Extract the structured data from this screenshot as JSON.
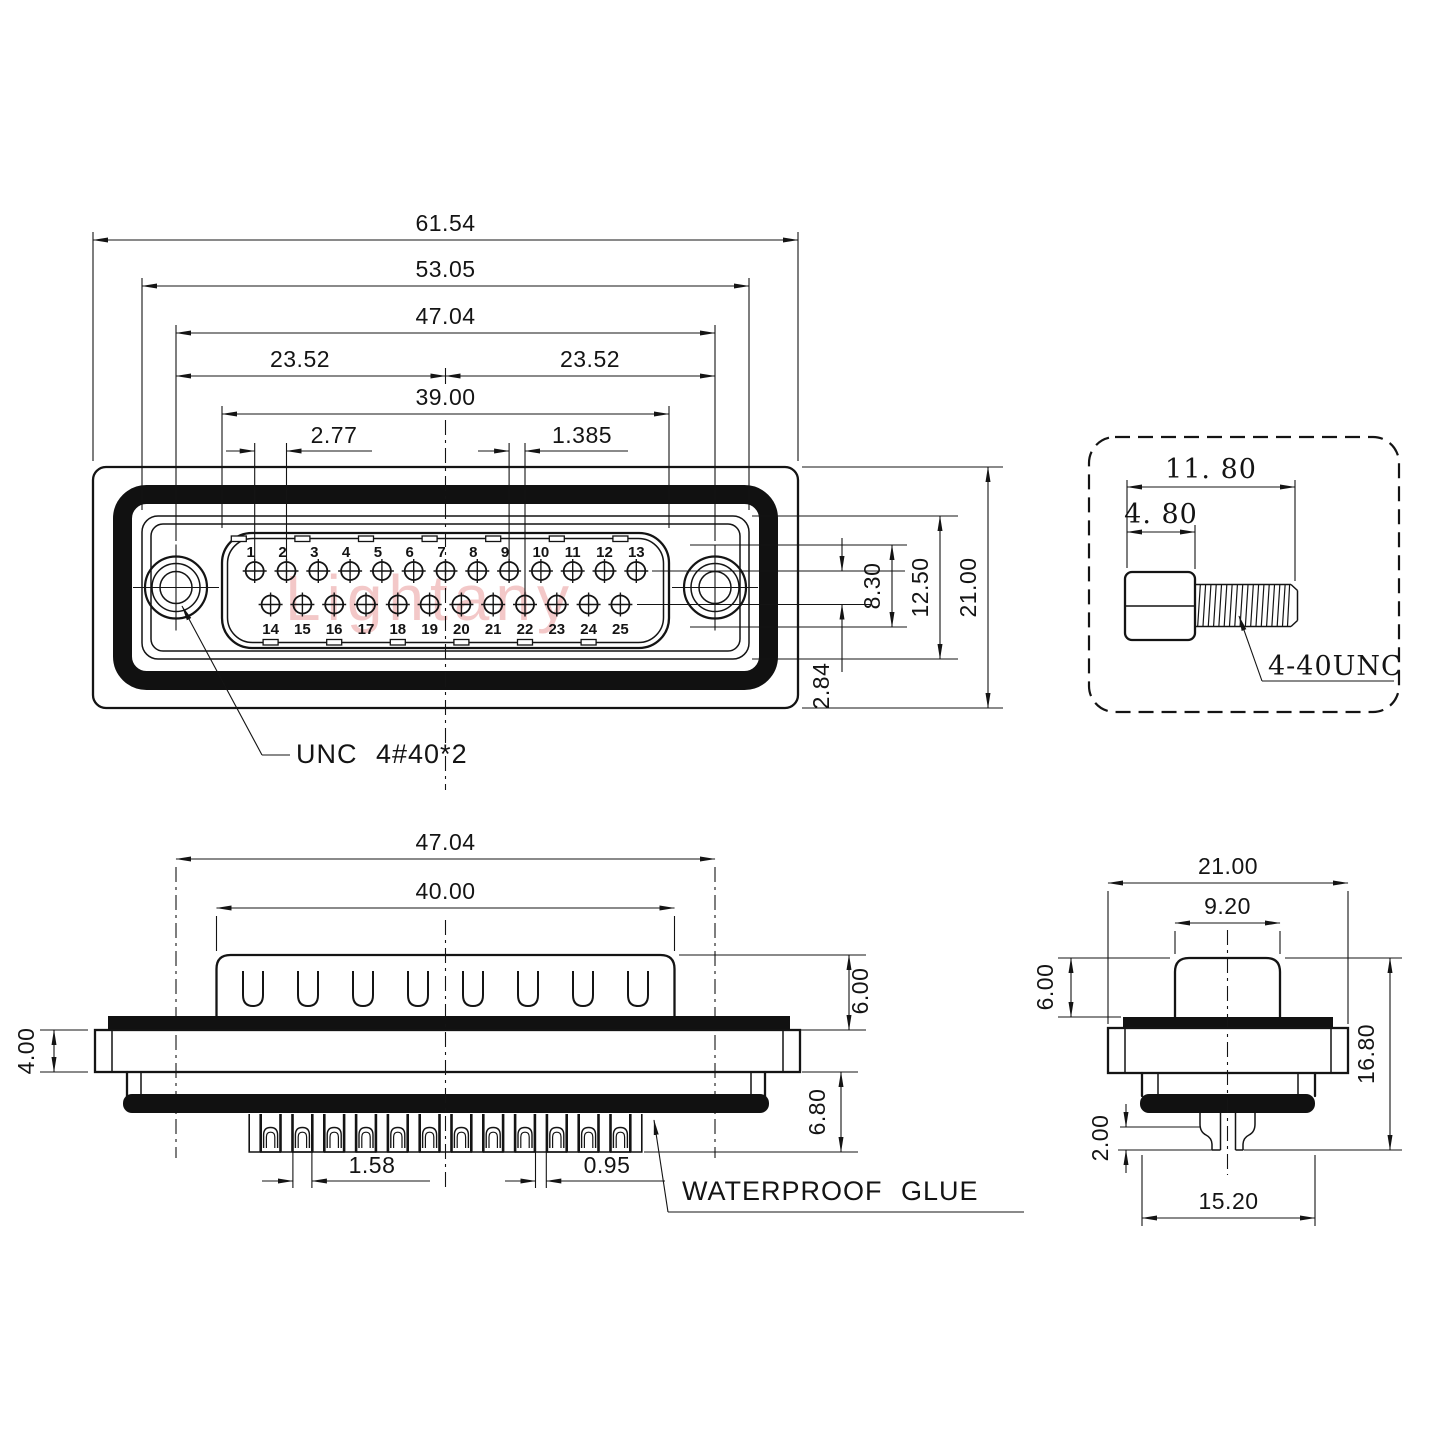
{
  "watermark": {
    "text": "Lightany"
  },
  "colors": {
    "line": "#141414",
    "watermark": "#eeb2b2"
  },
  "front": {
    "dim_overall_w": "61.54",
    "dim_gasket_w": "53.05",
    "dim_hole_span": "47.04",
    "dim_half_l": "23.52",
    "dim_half_r": "23.52",
    "dim_shell_w": "39.00",
    "dim_pitch": "2.77",
    "dim_offset": "1.385",
    "dim_pinfield_h": "8.30",
    "dim_insert_h": "12.50",
    "dim_overall_h": "21.00",
    "dim_row_gap": "2.84",
    "thread_label": "UNC 4#40*2",
    "pins_top": [
      "1",
      "2",
      "3",
      "4",
      "5",
      "6",
      "7",
      "8",
      "9",
      "10",
      "11",
      "12",
      "13"
    ],
    "pins_bottom": [
      "14",
      "15",
      "16",
      "17",
      "18",
      "19",
      "20",
      "21",
      "22",
      "23",
      "24",
      "25"
    ]
  },
  "screw": {
    "dim_length": "11. 80",
    "dim_head": "4. 80",
    "thread_label": "4-40UNC"
  },
  "side": {
    "dim_hole_span": "47.04",
    "dim_shell_w": "40.00",
    "dim_flange_t": "4.00",
    "dim_shell_h": "6.00",
    "dim_lower_h": "6.80",
    "dim_pin_w": "1.58",
    "dim_pin_inner_w": "0.95",
    "glue_label": "WATERPROOF GLUE"
  },
  "profile": {
    "dim_flange_w": "21.00",
    "dim_shell_w": "9.20",
    "dim_shell_h": "6.00",
    "dim_total_h": "16.80",
    "dim_pin_step": "2.00",
    "dim_body_w": "15.20"
  }
}
